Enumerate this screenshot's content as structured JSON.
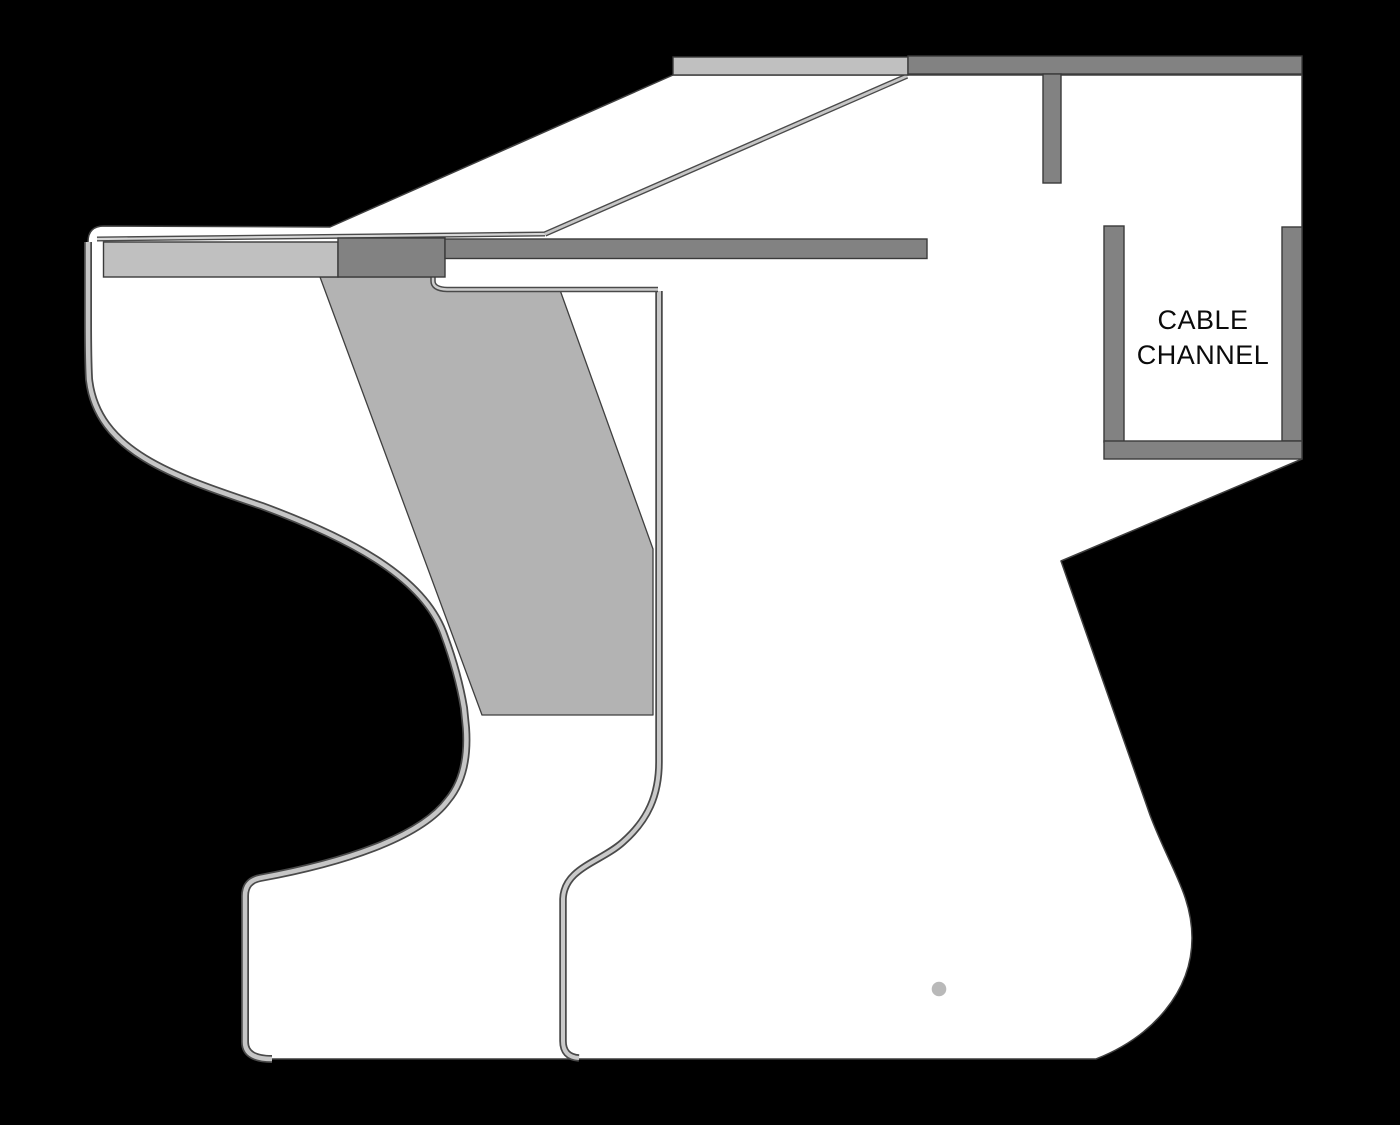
{
  "label": {
    "line1": "CABLE",
    "line2": "CHANNEL"
  },
  "colors": {
    "background": "#000000",
    "panel_white": "#ffffff",
    "light_bar": "#c0c0c0",
    "mid_bar": "#828282",
    "slant_panel": "#b3b3b3",
    "edge_band": "#c6c6c6",
    "edge_band_dark": "#4a4a4a",
    "outline": "#3f3f3f",
    "dot": "#b9b9b9",
    "label_color": "#0b0b0b"
  }
}
